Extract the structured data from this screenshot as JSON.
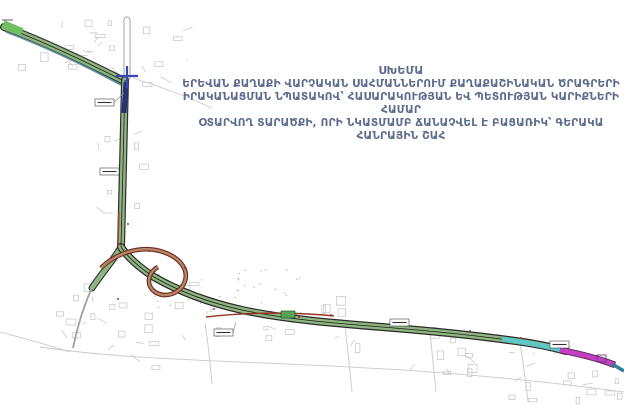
{
  "header": {
    "line1": "ՍԽԵՄԱ",
    "line2": "ԵՐԵՎԱՆ ՔԱՂԱՔԻ ՎԱՐՉԱԿԱՆ ՍԱՀՄԱՆՆԵՐՈՒՄ ՔԱՂԱՔԱՇԻՆԱԿԱՆ ԾՐԱԳՐԵՐԻ",
    "line3": "ԻՐԱԿԱՆԱՑՄԱՆ ՆՊԱՏԱԿՈՎ՝ ՀԱՍԱՐԱԿՈՒԹՅԱՆ ԵՎ ՊԵՏՈՒԹՅԱՆ ԿԱՐԻՔՆԵՐԻ ՀԱՄԱՐ",
    "line4": "ՕՏԱՐՎՈՂ ՏԱՐԱԾՔԻ, ՈՐԻ ՆԿԱՏՄԱՄԲ ՃԱՆԱՉՎԵԼ Է ԲԱՑԱՌԻԿ՝ ԳԵՐԱԿԱ ՀԱՆՐԱՅԻՆ ՇԱՀ"
  },
  "colors": {
    "title": "#5c6a8c",
    "road_fill": "#8fb681",
    "road_casing": "#2e2e2e",
    "center_line": "#1b1b1b",
    "ramp_fill": "#b5876a",
    "ramp_casing": "#6e2a1c",
    "teal": "#5fc8c4",
    "teal_dark": "#2e7f8f",
    "magenta": "#c43fc4",
    "magenta_casing": "#5a2a5a",
    "navy": "#24327a",
    "junction_blue": "#3946b8",
    "accent_red": "#a93226",
    "map_gray": "#c2c2c2"
  },
  "map": {
    "roads": [
      {
        "name": "north-road-stub",
        "path": "M127,20 L127,77",
        "casing": "#9a9a9a",
        "cw": 7,
        "fill": "#ffffff",
        "fw": 5.2,
        "center": false
      },
      {
        "name": "northwest-avenue",
        "path": "M4,27 C38,39 78,58 122,80",
        "casing": "#2e3b2a",
        "cw": 8,
        "fill": "#8fb681",
        "fw": 5.6,
        "center": true
      },
      {
        "name": "south-avenue",
        "path": "M125,80 C124,135 122,195 121,247",
        "casing": "#2e2e2e",
        "cw": 8,
        "fill": "#8fb681",
        "fw": 5.6,
        "center": true
      },
      {
        "name": "interchange-left-branch",
        "path": "M121,247 C113,261 102,273 92,288",
        "casing": "#2e2e2e",
        "cw": 7,
        "fill": "#8fb681",
        "fw": 4.8,
        "center": false
      },
      {
        "name": "mainline-highway",
        "path": "M121,247 C129,259 140,268 154,277 C173,288 202,301 242,310 C284,319 332,323 382,327 C432,331 472,335 508,340 C532,343 552,347 566,351",
        "casing": "#2a2a2a",
        "cw": 8,
        "fill": "#8fb681",
        "fw": 5.6,
        "center": true
      }
    ],
    "overlays": [
      {
        "name": "nw-teal-edge",
        "path": "M6,32 C38,44 78,62 121,85",
        "color": "#5e8fa0",
        "width": 1.6
      },
      {
        "name": "nw-green-head",
        "path": "M3,24 L22,32",
        "color": "#6fbf63",
        "width": 8
      },
      {
        "name": "navy-section",
        "path": "M126,82 L124,113",
        "color": "#24327a",
        "width": 5
      },
      {
        "name": "red-edge-vertical",
        "path": "M119,212 L118,246",
        "color": "#a0402e",
        "width": 1.4
      },
      {
        "name": "teal-section",
        "path": "M502,339 C524,342 546,346 566,351",
        "color": "#5fc8c4",
        "width": 5
      },
      {
        "name": "magenta-section-casing",
        "path": "M560,350 C580,354 600,359 615,365",
        "color": "#5a2a5a",
        "width": 6.6
      },
      {
        "name": "magenta-section",
        "path": "M560,350 C580,354 600,359 615,365",
        "color": "#c43fc4",
        "width": 4.8
      },
      {
        "name": "end-teal-section",
        "path": "M612,364 L624,371",
        "color": "#2e7f8f",
        "width": 3.5
      },
      {
        "name": "loop-ramp-casing",
        "path": "M101,268 C117,252 141,246 160,251 C178,256 189,268 185,281 C181,293 166,299 155,292 C146,286 147,273 158,267",
        "color": "#6e2a1c",
        "width": 4.6
      },
      {
        "name": "loop-ramp",
        "path": "M101,268 C117,252 141,246 160,251 C178,256 189,268 185,281 C181,293 166,299 155,292 C146,286 147,273 158,267",
        "color": "#b5876a",
        "width": 2.4
      },
      {
        "name": "old-alignment-red-line",
        "path": "M206,317 C248,312 296,312 334,316",
        "color": "#993322",
        "width": 1.4
      },
      {
        "name": "junction-blue-horizontal",
        "path": "M116,76 L138,76",
        "color": "#3946b8",
        "width": 2.2
      },
      {
        "name": "junction-blue-vertical",
        "path": "M127,66 L127,88",
        "color": "#3946b8",
        "width": 2.2
      },
      {
        "name": "gray-tail-road",
        "path": "M92,288 C85,303 78,324 73,348",
        "color": "#9f9f9f",
        "width": 1.8
      }
    ],
    "markers": [
      {
        "x": 2,
        "y": 18,
        "w": 11,
        "h": 5,
        "box": false,
        "tx": 2,
        "ty": 18
      },
      {
        "x": 95,
        "y": 99,
        "w": 19,
        "h": 7,
        "box": true,
        "tx": 124,
        "ty": 93
      },
      {
        "x": 100,
        "y": 168,
        "w": 19,
        "h": 7,
        "box": true,
        "tx": 120,
        "ty": 172
      },
      {
        "x": 214,
        "y": 329,
        "w": 19,
        "h": 7,
        "box": true,
        "tx": 236,
        "ty": 322
      },
      {
        "x": 390,
        "y": 319,
        "w": 19,
        "h": 7,
        "box": true,
        "tx": 408,
        "ty": 329
      },
      {
        "x": 550,
        "y": 341,
        "w": 19,
        "h": 7,
        "box": true,
        "tx": 566,
        "ty": 350
      }
    ],
    "dots_red": [
      [
        149,
        251
      ],
      [
        185,
        268
      ],
      [
        118,
        299
      ],
      [
        299,
        317
      ],
      [
        331,
        315
      ],
      [
        214,
        309
      ],
      [
        470,
        331
      ],
      [
        521,
        338
      ],
      [
        585,
        358
      ],
      [
        128,
        224
      ]
    ],
    "bridge_rect": {
      "x": 281,
      "y": 311,
      "w": 14,
      "h": 7
    }
  }
}
